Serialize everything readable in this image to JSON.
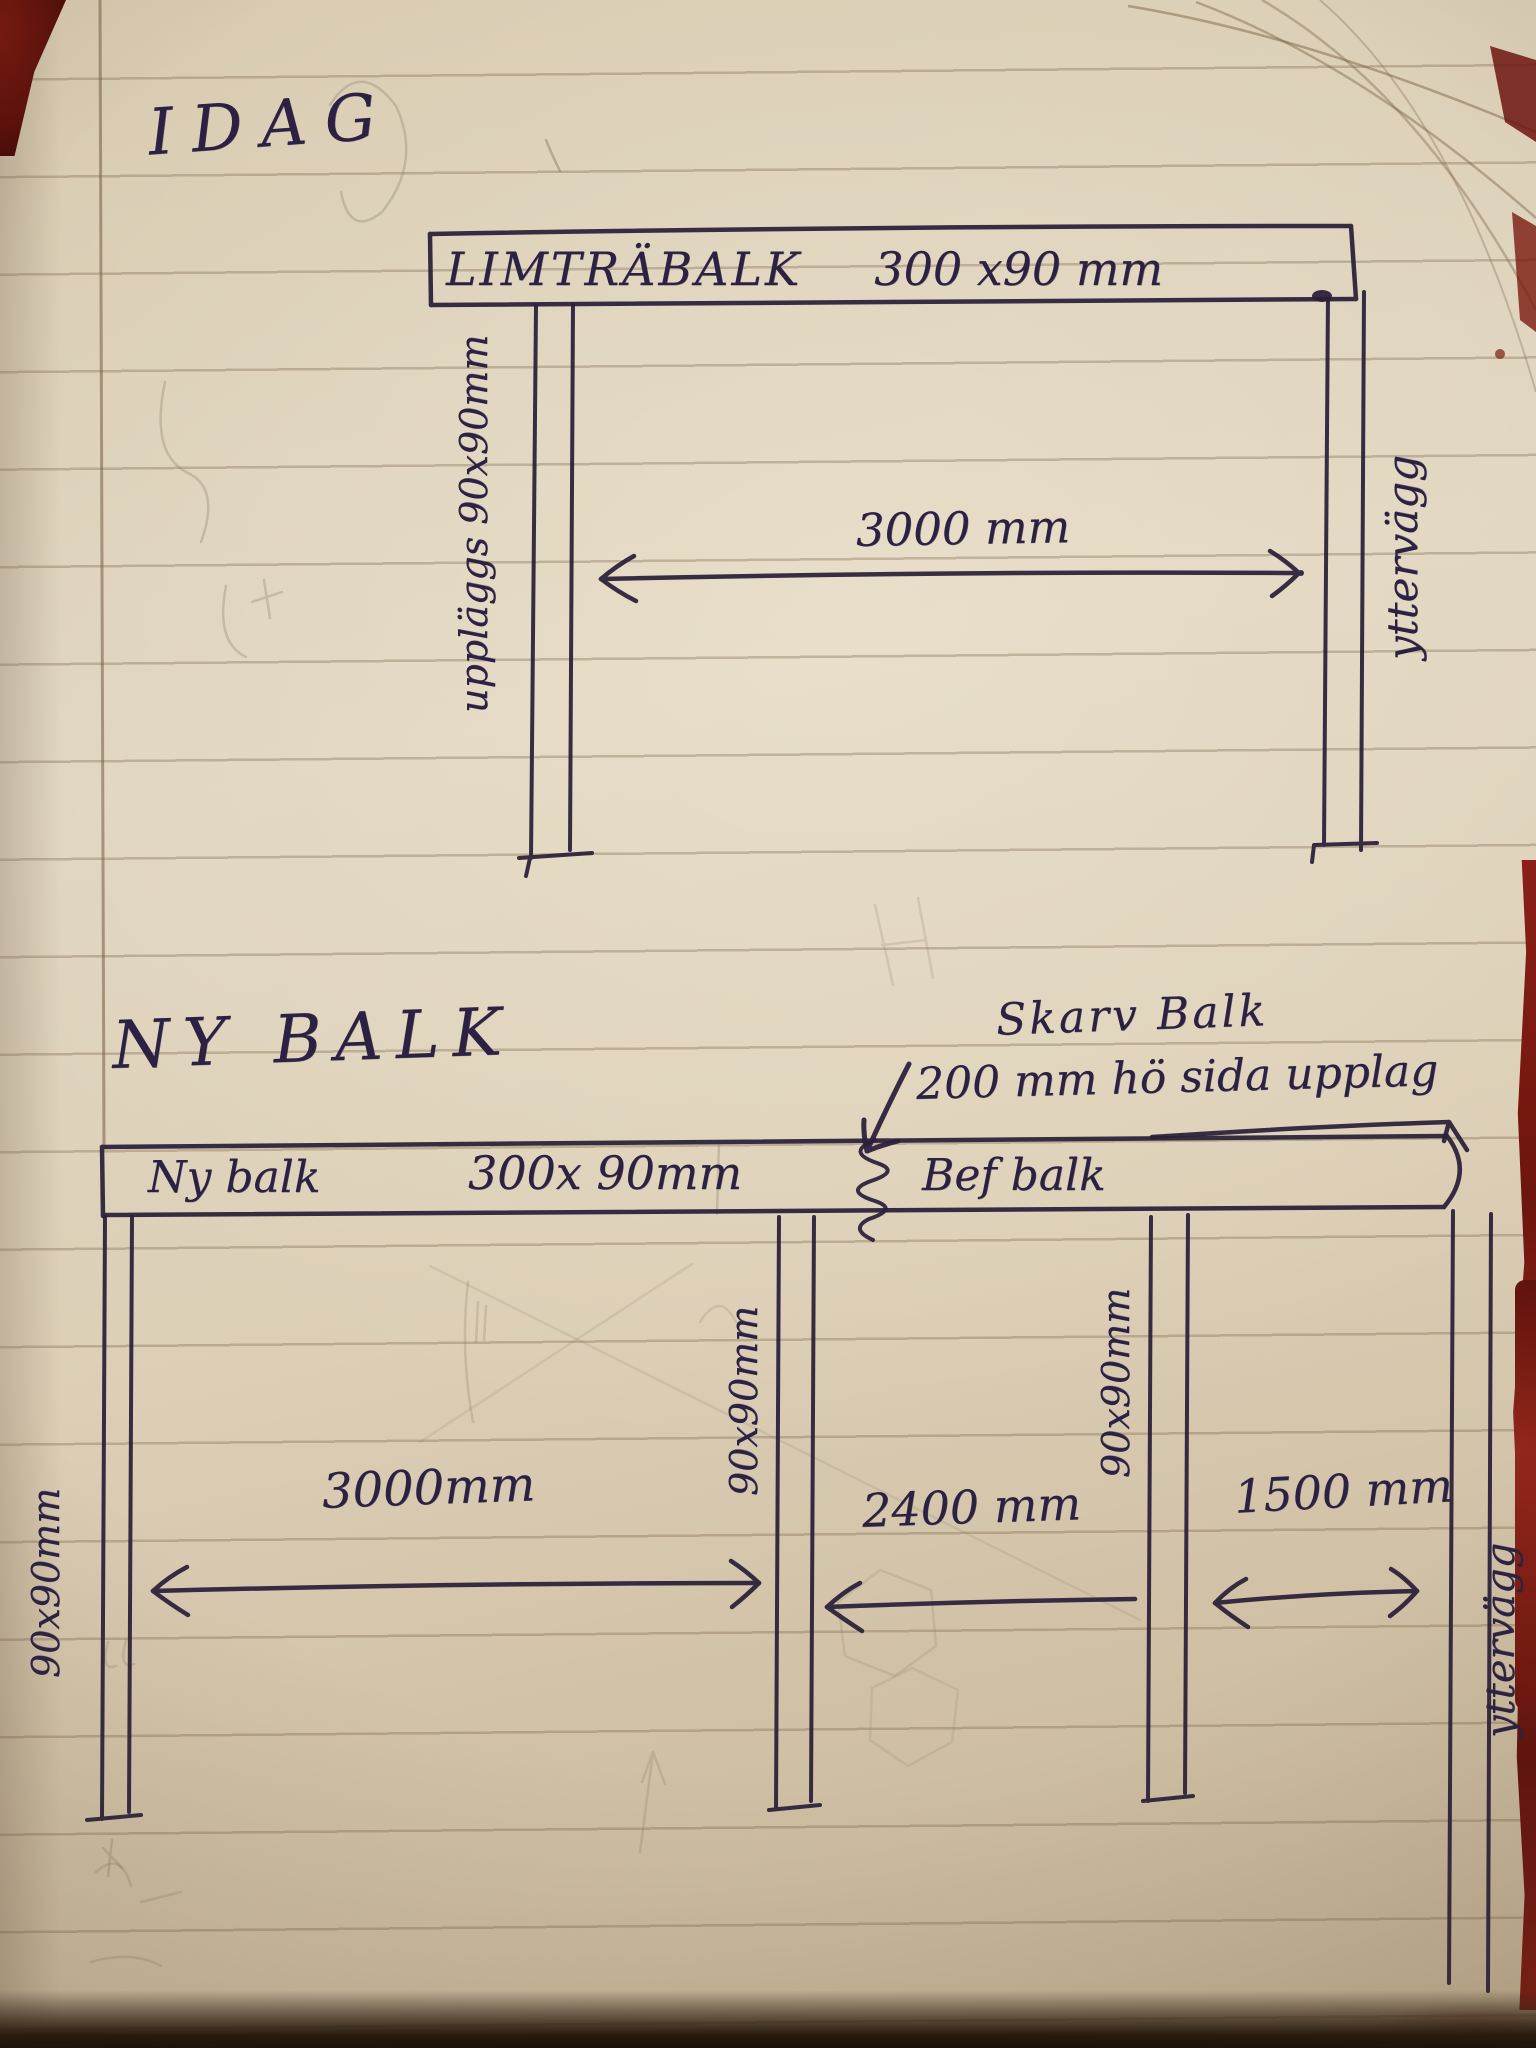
{
  "colors": {
    "paper": "#ddd1b8",
    "ink": "#2b1f3a",
    "ruled_line": "rgba(120,98,70,0.34)",
    "pencil": "#857763",
    "cover_red": "#7c1a12"
  },
  "top_sketch": {
    "heading": "IDAG",
    "beam_name": "LIMTRÄBALK",
    "beam_size": "300 x90 mm",
    "left_support_label": "uppläggs 90x90mm",
    "right_wall_label": "yttervägg",
    "span_dimension": "3000 mm"
  },
  "bottom_sketch": {
    "heading": "NY BALK",
    "splice_note_line1": "Skarv Balk",
    "splice_note_line2": "200 mm hö sida upplag",
    "new_beam_label": "Ny balk",
    "new_beam_size": "300x 90mm",
    "existing_beam_label": "Bef balk",
    "post_left_label": "90x90mm",
    "post_mid_label": "90x90mm",
    "post_right_label": "90x90mm",
    "wall_label": "yttervägg",
    "dim_left": "3000mm",
    "dim_mid": "2400 mm",
    "dim_right": "1500 mm"
  }
}
